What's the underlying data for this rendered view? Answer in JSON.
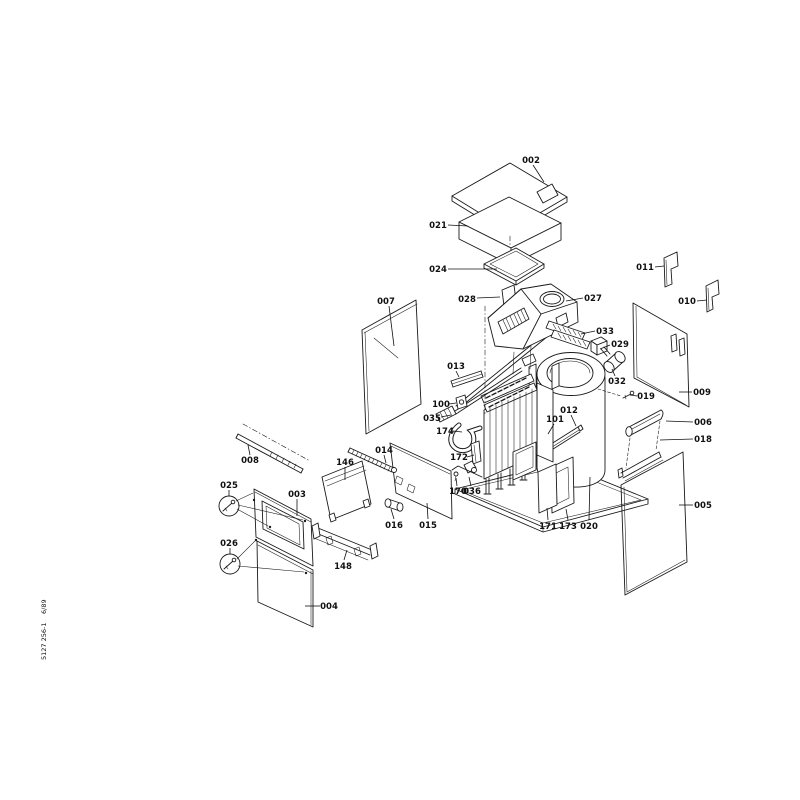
{
  "document": {
    "kind": "exploded-parts-diagram",
    "background": "#ffffff",
    "ink": "#1a1a1a"
  },
  "footer": {
    "code": "5127 256-1",
    "date": "6/89"
  },
  "diagram": {
    "parts": [
      {
        "label": "002",
        "x": 531,
        "y": 160,
        "line": [
          533,
          165,
          544,
          182
        ]
      },
      {
        "label": "021",
        "x": 438,
        "y": 225,
        "line": [
          448,
          225,
          468,
          226
        ]
      },
      {
        "label": "024",
        "x": 438,
        "y": 269,
        "line": [
          448,
          269,
          497,
          269
        ]
      },
      {
        "label": "028",
        "x": 467,
        "y": 299,
        "line": [
          477,
          298,
          500,
          297
        ]
      },
      {
        "label": "027",
        "x": 593,
        "y": 298,
        "line": [
          583,
          298,
          566,
          301
        ]
      },
      {
        "label": "033",
        "x": 605,
        "y": 331,
        "line": [
          595,
          331,
          581,
          334
        ]
      },
      {
        "label": "029",
        "x": 620,
        "y": 344,
        "line": [
          610,
          345,
          600,
          349
        ]
      },
      {
        "label": "032",
        "x": 617,
        "y": 381,
        "line": [
          615,
          376,
          612,
          369
        ]
      },
      {
        "label": "011",
        "x": 645,
        "y": 267,
        "line": [
          655,
          267,
          664,
          266
        ]
      },
      {
        "label": "010",
        "x": 687,
        "y": 301,
        "line": [
          697,
          301,
          707,
          300
        ]
      },
      {
        "label": "009",
        "x": 702,
        "y": 392,
        "line": [
          692,
          392,
          679,
          392
        ]
      },
      {
        "label": "019",
        "x": 646,
        "y": 396,
        "line": [
          637,
          396,
          630,
          395
        ]
      },
      {
        "label": "006",
        "x": 703,
        "y": 422,
        "line": [
          693,
          422,
          666,
          421
        ]
      },
      {
        "label": "018",
        "x": 703,
        "y": 439,
        "line": [
          693,
          439,
          660,
          440
        ]
      },
      {
        "label": "005",
        "x": 703,
        "y": 505,
        "line": [
          693,
          505,
          679,
          505
        ]
      },
      {
        "label": "013",
        "x": 456,
        "y": 366,
        "line": [
          456,
          371,
          459,
          377
        ]
      },
      {
        "label": "100",
        "x": 441,
        "y": 404,
        "line": [
          449,
          404,
          456,
          403
        ]
      },
      {
        "label": "035",
        "x": 432,
        "y": 418,
        "line": [
          441,
          417,
          451,
          415
        ]
      },
      {
        "label": "174",
        "x": 445,
        "y": 431,
        "line": [
          453,
          431,
          462,
          432
        ]
      },
      {
        "label": "172",
        "x": 459,
        "y": 457,
        "line": [
          467,
          457,
          474,
          455
        ]
      },
      {
        "label": "170",
        "x": 458,
        "y": 491,
        "line": [
          457,
          486,
          456,
          478
        ]
      },
      {
        "label": "036",
        "x": 472,
        "y": 491,
        "line": [
          471,
          486,
          469,
          477
        ]
      },
      {
        "label": "101",
        "x": 555,
        "y": 419,
        "line": [
          554,
          424,
          548,
          434
        ]
      },
      {
        "label": "012",
        "x": 569,
        "y": 410,
        "line": [
          571,
          415,
          576,
          426
        ]
      },
      {
        "label": "020",
        "x": 589,
        "y": 526,
        "line": [
          589,
          520,
          590,
          477
        ]
      },
      {
        "label": "171",
        "x": 548,
        "y": 526,
        "line": [
          548,
          520,
          547,
          508
        ]
      },
      {
        "label": "173",
        "x": 568,
        "y": 526,
        "line": [
          568,
          520,
          566,
          509
        ]
      },
      {
        "label": "007",
        "x": 386,
        "y": 301,
        "line": [
          389,
          306,
          394,
          346
        ]
      },
      {
        "label": "008",
        "x": 250,
        "y": 460,
        "line": [
          250,
          455,
          248,
          445
        ]
      },
      {
        "label": "146",
        "x": 345,
        "y": 462,
        "line": [
          345,
          467,
          345,
          480
        ]
      },
      {
        "label": "014",
        "x": 384,
        "y": 450,
        "line": [
          384,
          455,
          386,
          463
        ]
      },
      {
        "label": "016",
        "x": 394,
        "y": 525,
        "line": [
          394,
          519,
          391,
          509
        ]
      },
      {
        "label": "015",
        "x": 428,
        "y": 525,
        "line": [
          428,
          519,
          427,
          503
        ]
      },
      {
        "label": "025",
        "x": 229,
        "y": 485,
        "line": [
          229,
          490,
          229,
          496
        ]
      },
      {
        "label": "026",
        "x": 229,
        "y": 543,
        "line": [
          230,
          548,
          230,
          554
        ]
      },
      {
        "label": "003",
        "x": 297,
        "y": 494,
        "line": [
          297,
          499,
          297,
          516
        ]
      },
      {
        "label": "004",
        "x": 329,
        "y": 606,
        "line": [
          320,
          606,
          305,
          606
        ]
      },
      {
        "label": "148",
        "x": 343,
        "y": 566,
        "line": [
          344,
          560,
          347,
          550
        ]
      }
    ]
  }
}
